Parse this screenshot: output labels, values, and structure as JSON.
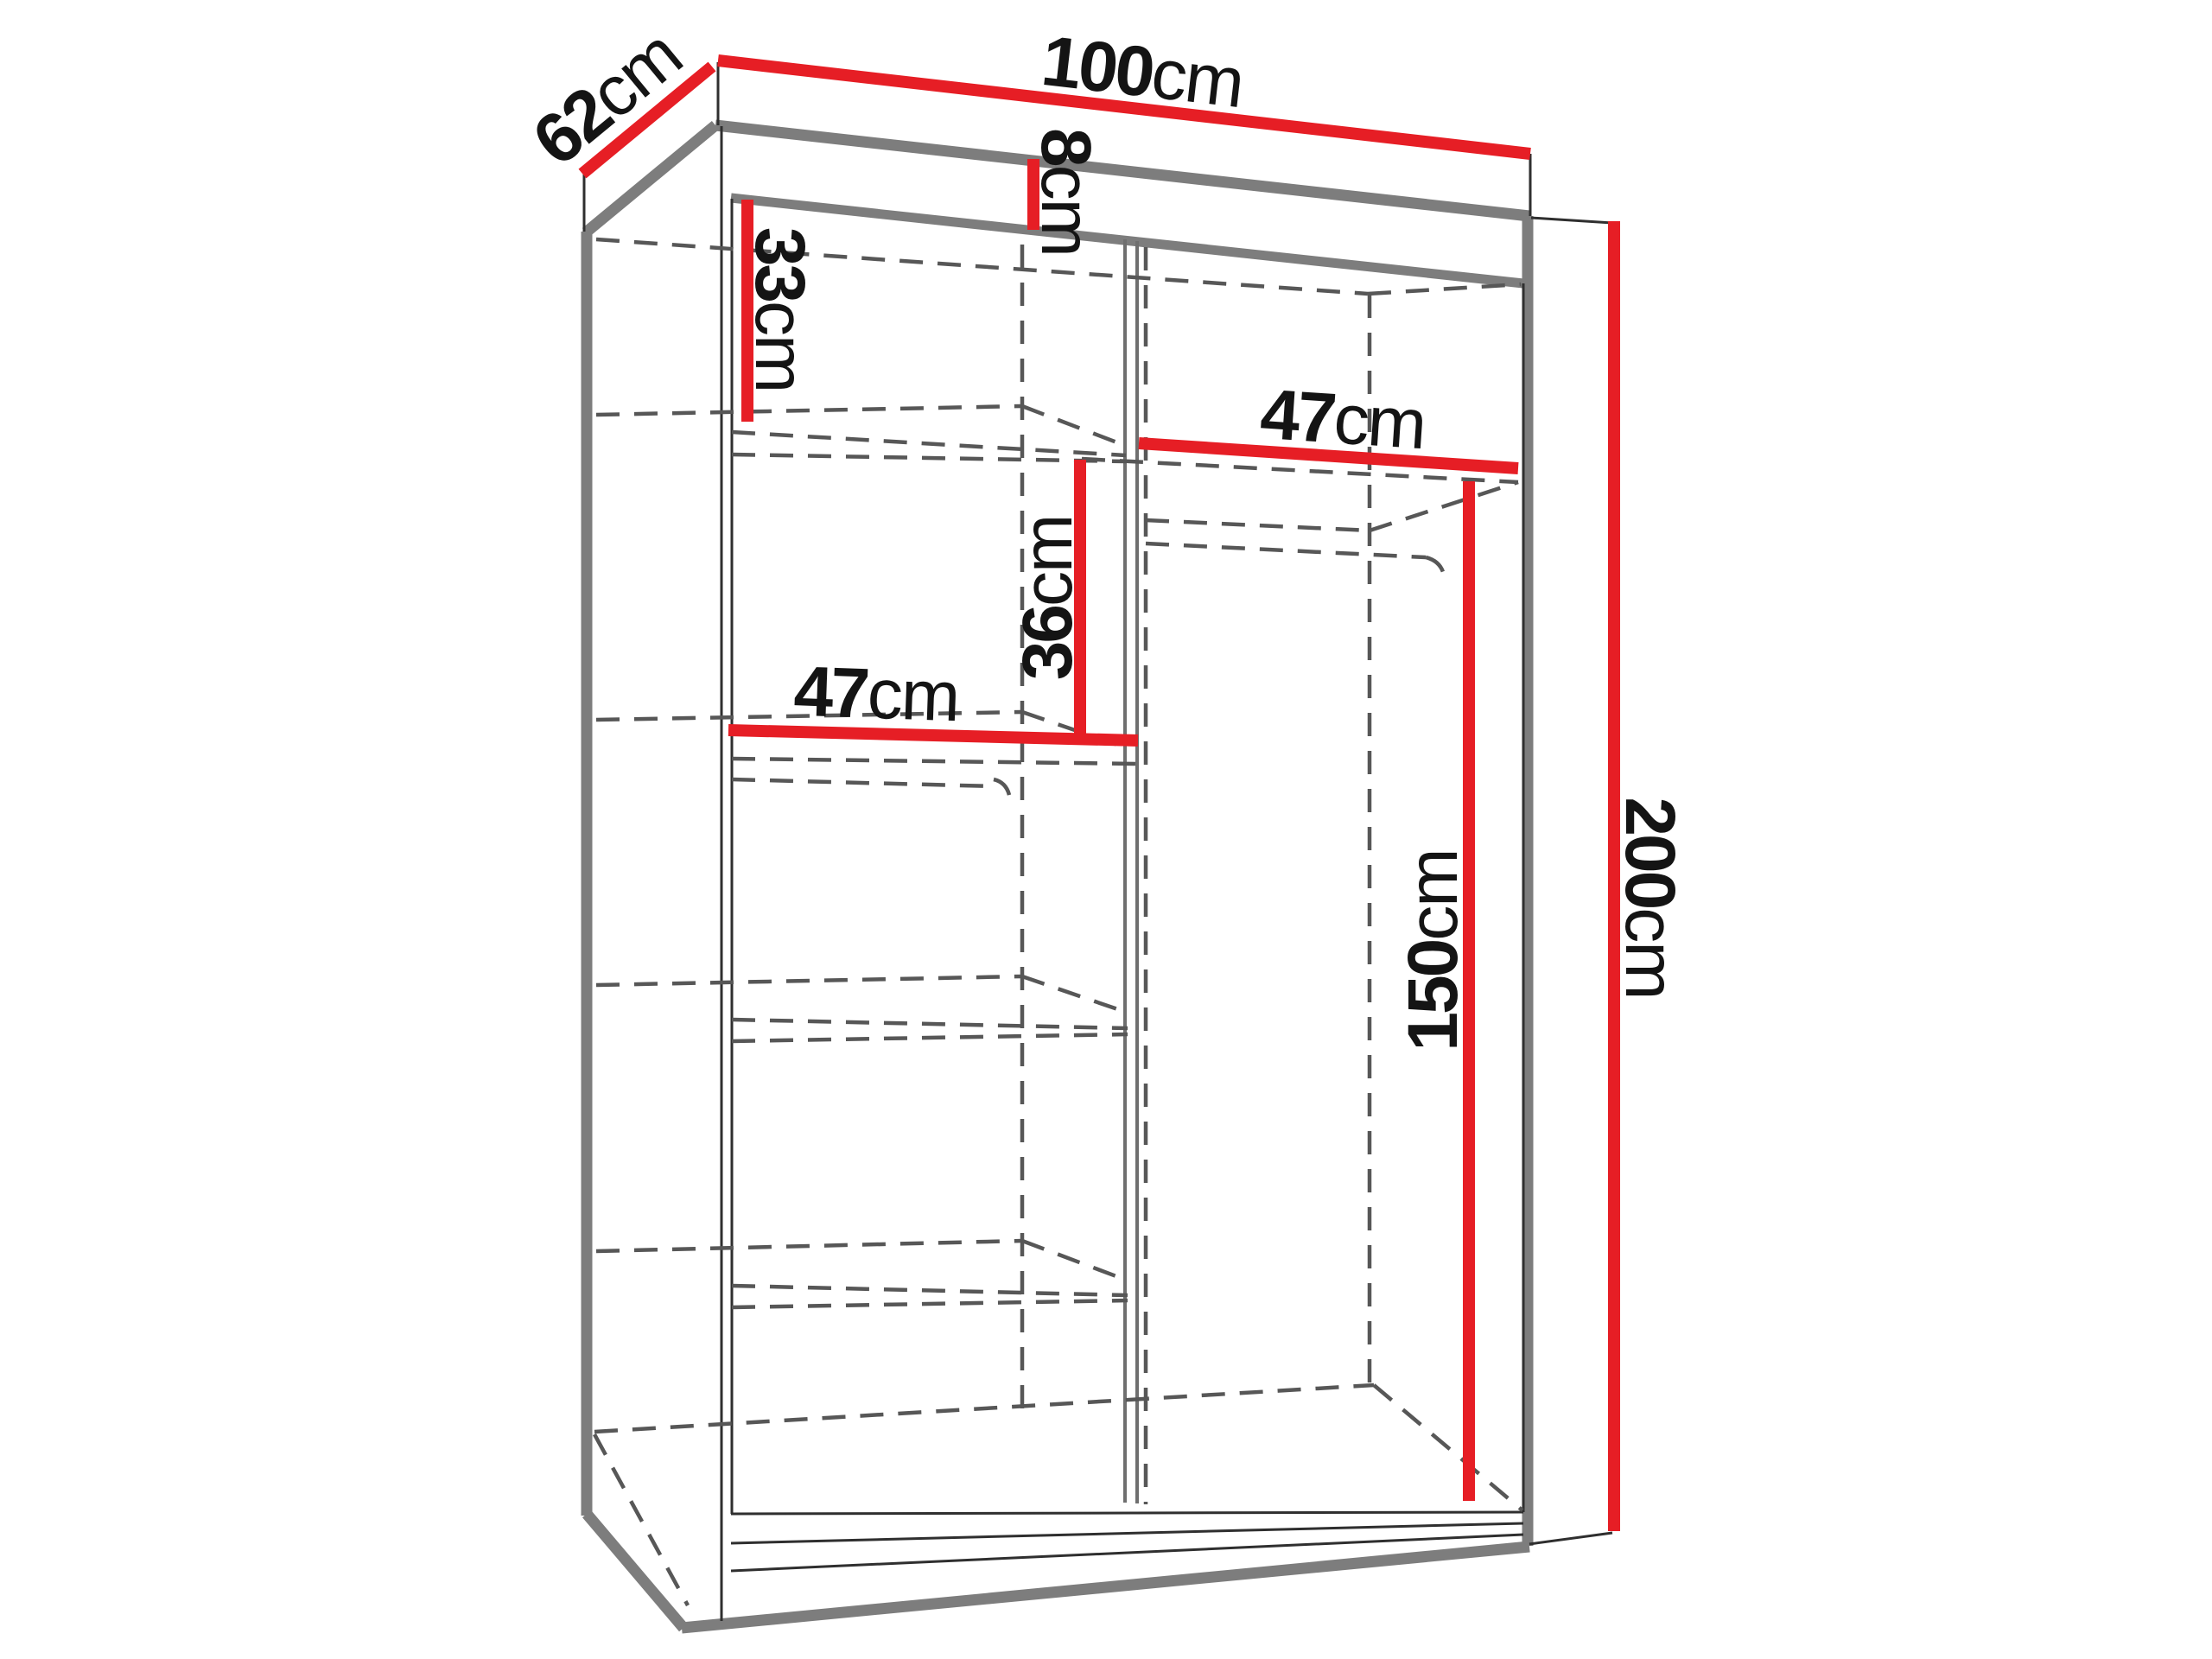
{
  "diagram": {
    "subject": "sliding-door wardrobe interior dimension drawing",
    "unit": "cm",
    "dimensions": {
      "width": {
        "value": "100",
        "unit": "cm"
      },
      "depth": {
        "value": "62",
        "unit": "cm"
      },
      "top_section": {
        "value": "8",
        "unit": "cm"
      },
      "upper_shelf_drop": {
        "value": "33",
        "unit": "cm"
      },
      "right_shelf_width": {
        "value": "47",
        "unit": "cm"
      },
      "shelf_offset": {
        "value": "36",
        "unit": "cm"
      },
      "left_shelf_width": {
        "value": "47",
        "unit": "cm"
      },
      "hanging_height": {
        "value": "150",
        "unit": "cm"
      },
      "total_height": {
        "value": "200",
        "unit": "cm"
      }
    },
    "colors": {
      "dimension_line_red": "#E61E25",
      "structure_gray": "#7D7D7D",
      "hidden_line_gray": "#575757",
      "edge_dark": "#2F2F2F",
      "background": "#FFFFFF",
      "text": "#141414"
    }
  }
}
